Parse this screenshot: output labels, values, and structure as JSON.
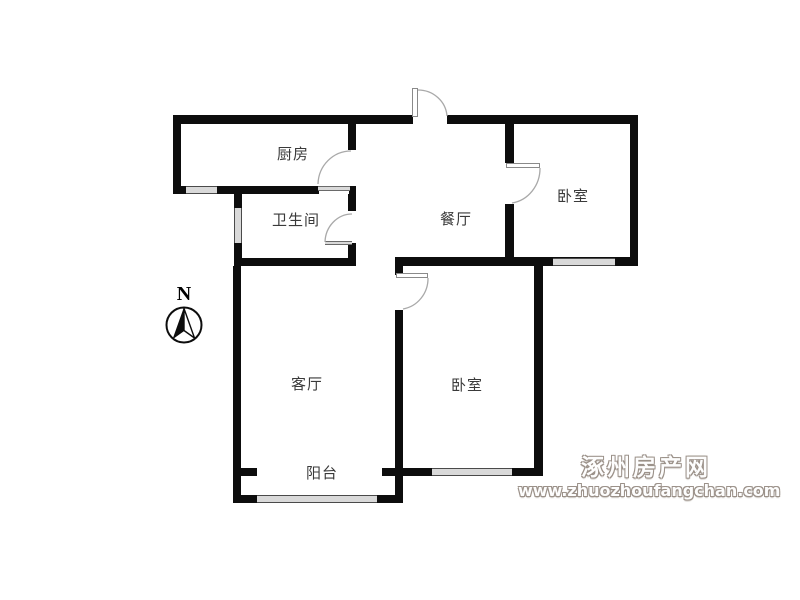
{
  "floorplan": {
    "rooms": {
      "kitchen": {
        "label": "厨房"
      },
      "bathroom": {
        "label": "卫生间"
      },
      "dining": {
        "label": "餐厅"
      },
      "bedroom_top": {
        "label": "卧室"
      },
      "living": {
        "label": "客厅"
      },
      "bedroom_bottom": {
        "label": "卧室"
      },
      "balcony": {
        "label": "阳台"
      }
    },
    "compass": {
      "north_label": "N"
    },
    "features": [
      "entrance-door",
      "kitchen-door",
      "bathroom-door",
      "bedroom-top-door",
      "bedroom-bottom-door",
      "kitchen-window",
      "bathroom-window",
      "bedroom-top-window",
      "bedroom-bottom-window",
      "balcony-window"
    ]
  },
  "watermark": {
    "site_name": "涿州房产网",
    "site_url": "www.zhuozhoufangchan.com"
  },
  "colors": {
    "wall": "#0d0d0d",
    "window_fill": "#d9d9d9",
    "label_text": "#3a3a3a",
    "watermark_gray": "#9b9189",
    "background": "#ffffff"
  }
}
